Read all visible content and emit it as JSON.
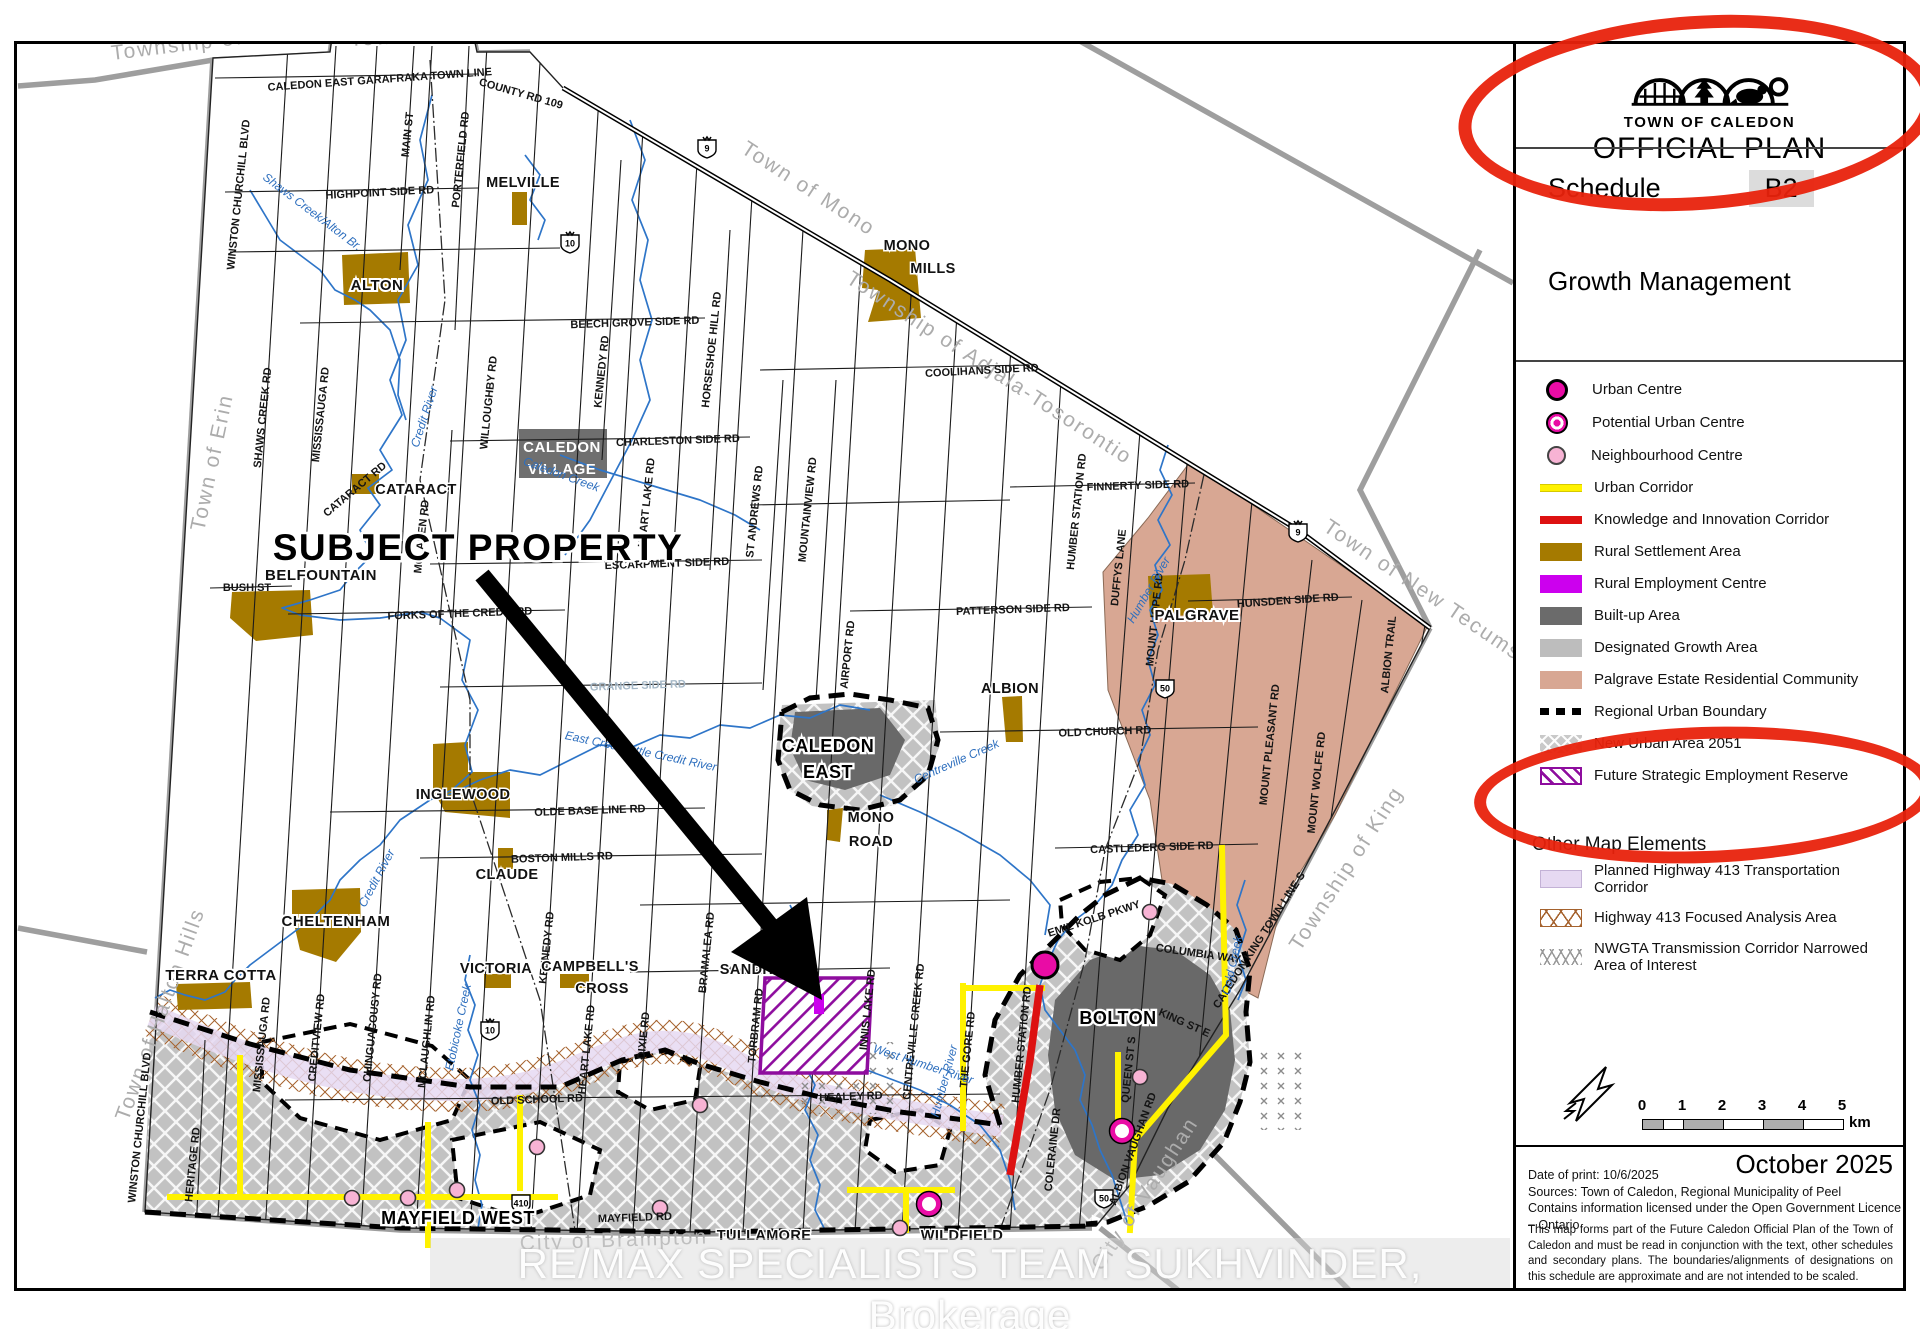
{
  "colors": {
    "accent_red": "#E8220C",
    "water": "#2E75C8",
    "rural_settlement": "#A57A00",
    "rural_employment": "#CC00EE",
    "built_up": "#6B6B6B",
    "designated_growth": "#BDBDBD",
    "palgrave_estate": "#D8A793",
    "urban_centre": "#E90CA5",
    "neighbourhood_centre": "#F7B3D4",
    "urban_corridor": "#FFF200",
    "knowledge_corridor": "#DD1111",
    "future_strategic": "#8E0D9E",
    "hwy413_corridor": "#E6D9F2"
  },
  "legend": {
    "org": "TOWN OF CALEDON",
    "plan": "OFFICIAL PLAN",
    "schedule_label": "Schedule",
    "schedule_value": "B2",
    "title": "Growth Management",
    "items": [
      {
        "label": "Urban Centre",
        "swatch": "urban-centre"
      },
      {
        "label": "Potential Urban Centre",
        "swatch": "potential-urban-centre"
      },
      {
        "label": "Neighbourhood Centre",
        "swatch": "neighbourhood-centre"
      },
      {
        "label": "Urban Corridor",
        "swatch": "urban-corridor"
      },
      {
        "label": "Knowledge and Innovation Corridor",
        "swatch": "knowledge-corridor"
      },
      {
        "label": "Rural Settlement Area",
        "swatch": "rural-settlement"
      },
      {
        "label": "Rural Employment Centre",
        "swatch": "rural-employment"
      },
      {
        "label": "Built-up Area",
        "swatch": "built-up"
      },
      {
        "label": "Designated Growth Area",
        "swatch": "designated-growth"
      },
      {
        "label": "Palgrave Estate Residential Community",
        "swatch": "palgrave-estate"
      },
      {
        "label": "Regional Urban Boundary",
        "swatch": "regional-urban-boundary"
      },
      {
        "label": "New Urban Area 2051",
        "swatch": "new-urban-area"
      },
      {
        "label": "Future Strategic Employment Reserve",
        "swatch": "future-strategic"
      }
    ],
    "other_heading": "Other Map Elements",
    "other_items": [
      {
        "label": "Planned Highway 413 Transportation Corridor",
        "swatch": "hwy413-corridor"
      },
      {
        "label": "Highway 413 Focused Analysis Area",
        "swatch": "hwy413-analysis"
      },
      {
        "label": "NWGTA Transmission Corridor Narrowed Area of Interest",
        "swatch": "nwgta"
      }
    ],
    "scale": {
      "ticks": [
        "0",
        "1",
        "2",
        "3",
        "4",
        "5"
      ],
      "unit": "km"
    },
    "date_big": "October 2025",
    "print_info": [
      "Date of print: 10/6/2025",
      "Sources: Town of Caledon, Regional Municipality of Peel",
      "Contains information licensed under the Open Government Licence – Ontario"
    ],
    "disclaimer": "This map forms part of the Future Caledon Official Plan of the Town of Caledon and must be read in conjunction with the text, other schedules and secondary plans. The boundaries/alignments of designations on this schedule are approximate and are not intended to be scaled."
  },
  "map": {
    "annotation": "SUBJECT PROPERTY",
    "watermark": "RE/MAX SPECIALISTS TEAM SUKHVINDER, Brokerage",
    "route_shields": [
      [
        "9",
        707,
        148
      ],
      [
        "9",
        1298,
        532
      ],
      [
        "10",
        570,
        243
      ],
      [
        "10",
        490,
        1030
      ],
      [
        "410",
        521,
        1203
      ],
      [
        "50",
        1165,
        688
      ],
      [
        "50",
        1104,
        1198
      ]
    ],
    "points": {
      "urban_centres": [
        [
          1045,
          965
        ]
      ],
      "potential_urban_centres": [
        [
          1122,
          1131
        ],
        [
          929,
          1204
        ]
      ],
      "neighbourhood_centres": [
        [
          352,
          1198
        ],
        [
          408,
          1198
        ],
        [
          457,
          1190
        ],
        [
          537,
          1147
        ],
        [
          660,
          1208
        ],
        [
          700,
          1105
        ],
        [
          900,
          1228
        ],
        [
          1150,
          912
        ],
        [
          1140,
          1077
        ]
      ]
    },
    "labels": [
      [
        "Township of East Garafraxa",
        112,
        60,
        -7,
        "m"
      ],
      [
        "Town of Orangeville",
        350,
        46,
        -3,
        "m"
      ],
      [
        "Town of Mono",
        740,
        152,
        33,
        "m"
      ],
      [
        "Township of Adjala-Tosorontio",
        845,
        282,
        33,
        "m"
      ],
      [
        "Town of New Tecumseth",
        1322,
        530,
        34,
        "m"
      ],
      [
        "Township of King",
        1300,
        952,
        -57,
        "m"
      ],
      [
        "City of Vaughan",
        1102,
        1272,
        -57,
        "m"
      ],
      [
        "City of Brampton",
        520,
        1250,
        -2,
        "m"
      ],
      [
        "Town of Halton Hills",
        128,
        1122,
        -70,
        "m"
      ],
      [
        "Town of Erin",
        204,
        532,
        -78,
        "m"
      ],
      [
        "CALEDON EAST GARAFRAKA TOWN LINE",
        380,
        83,
        -4,
        "r"
      ],
      [
        "COUNTY RD 109",
        520,
        97,
        16,
        "r"
      ],
      [
        "HIGHPOINT SIDE RD",
        380,
        196,
        -3,
        "r"
      ],
      [
        "BEECH GROVE SIDE RD",
        635,
        326,
        -2,
        "r"
      ],
      [
        "COOLIHANS SIDE RD",
        982,
        374,
        -3,
        "r"
      ],
      [
        "CHARLESTON SIDE RD",
        678,
        444,
        -2,
        "r"
      ],
      [
        "FINNERTY SIDE RD",
        1138,
        489,
        -2,
        "r"
      ],
      [
        "ESCARPMENT SIDE RD",
        667,
        567,
        -2,
        "r"
      ],
      [
        "BUSH ST",
        247,
        591,
        0,
        "r"
      ],
      [
        "FORKS OF THE CREDIT RD",
        460,
        617,
        -2,
        "r"
      ],
      [
        "HUNSDEN SIDE RD",
        1288,
        604,
        -4,
        "r"
      ],
      [
        "PATTERSON SIDE RD",
        1013,
        613,
        -2,
        "r"
      ],
      [
        "GRANGE SIDE RD",
        638,
        689,
        -2,
        "rf"
      ],
      [
        "OLD CHURCH RD",
        1105,
        735,
        -2,
        "r"
      ],
      [
        "OLDE BASE LINE RD",
        590,
        814,
        -2,
        "r"
      ],
      [
        "CASTLEDERG SIDE RD",
        1152,
        851,
        -2,
        "r"
      ],
      [
        "BOSTON MILLS RD",
        562,
        861,
        -2,
        "r"
      ],
      [
        "KING ST",
        743,
        974,
        -1,
        "r"
      ],
      [
        "OLD SCHOOL RD",
        537,
        1103,
        -2,
        "r"
      ],
      [
        "HEALEY RD",
        851,
        1100,
        -2,
        "r"
      ],
      [
        "MAYFIELD RD",
        635,
        1221,
        -2,
        "r"
      ],
      [
        "EMIL KOLB PKWY",
        1095,
        922,
        -18,
        "r"
      ],
      [
        "COLUMBIA WAY",
        1198,
        957,
        8,
        "r"
      ],
      [
        "KING ST E",
        1183,
        1026,
        24,
        "r"
      ],
      [
        "WINSTON CHURCHILL BLVD",
        242,
        195,
        -84,
        "rv"
      ],
      [
        "WINSTON CHURCHILL BLVD",
        143,
        1128,
        -84,
        "rv"
      ],
      [
        "HERITAGE RD",
        196,
        1165,
        -84,
        "rv"
      ],
      [
        "MISSISSAUGA RD",
        265,
        1045,
        -84,
        "rv"
      ],
      [
        "MISSISSAUGA RD",
        324,
        415,
        -84,
        "rv"
      ],
      [
        "SHAWS CREEK RD",
        266,
        418,
        -84,
        "rv"
      ],
      [
        "CREDITVIEW RD",
        320,
        1038,
        -84,
        "rv"
      ],
      [
        "CHINGUACOUSY RD",
        376,
        1028,
        -84,
        "rv"
      ],
      [
        "MCLAUGHLIN RD",
        430,
        1042,
        -84,
        "rv"
      ],
      [
        "MCLAREN RD",
        425,
        537,
        -84,
        "rv"
      ],
      [
        "WILLOUGHBY RD",
        492,
        403,
        -84,
        "rv"
      ],
      [
        "KENNEDY RD",
        605,
        372,
        -84,
        "rv"
      ],
      [
        "KENNEDY RD",
        550,
        948,
        -84,
        "rv"
      ],
      [
        "HEART LAKE RD",
        650,
        503,
        -84,
        "rv"
      ],
      [
        "HEART LAKE RD",
        590,
        1050,
        -84,
        "rv"
      ],
      [
        "DIXIE RD",
        647,
        1036,
        -84,
        "rv"
      ],
      [
        "MAIN ST",
        411,
        135,
        -84,
        "rv"
      ],
      [
        "PORTERFIELD RD",
        464,
        160,
        -84,
        "rv"
      ],
      [
        "HORSESHOE HILL RD",
        715,
        350,
        -84,
        "rv"
      ],
      [
        "ST ANDREWS RD",
        758,
        512,
        -84,
        "rv"
      ],
      [
        "MOUNTAINVIEW RD",
        811,
        510,
        -84,
        "rv"
      ],
      [
        "AIRPORT RD",
        851,
        655,
        -84,
        "rv"
      ],
      [
        "BRAMALEA RD",
        710,
        953,
        -84,
        "rv"
      ],
      [
        "TORBRAM RD",
        759,
        1026,
        -84,
        "rv"
      ],
      [
        "INNIS LAKE RD",
        871,
        1010,
        -84,
        "rv"
      ],
      [
        "CENTREVILLE CREEK RD",
        917,
        1032,
        -84,
        "rv"
      ],
      [
        "THE GORE RD",
        971,
        1050,
        -84,
        "rv"
      ],
      [
        "HUMBER STATION RD",
        1025,
        1045,
        -84,
        "rv"
      ],
      [
        "HUMBER STATION RD",
        1080,
        512,
        -84,
        "rv"
      ],
      [
        "DUFFYS LANE",
        1122,
        568,
        -84,
        "rv"
      ],
      [
        "MOUNT HOPE RD",
        1158,
        620,
        -84,
        "rv"
      ],
      [
        "MOUNT PLEASANT RD",
        1273,
        745,
        -84,
        "rv"
      ],
      [
        "MOUNT WOLFE RD",
        1320,
        783,
        -84,
        "rv"
      ],
      [
        "ALBION TRAIL",
        1392,
        655,
        -84,
        "rv"
      ],
      [
        "COLERAINE DR",
        1056,
        1150,
        -84,
        "rv"
      ],
      [
        "ALBION VAUGHAN RD",
        1136,
        1150,
        -70,
        "rv"
      ],
      [
        "QUEEN ST S",
        1132,
        1070,
        -84,
        "rv"
      ],
      [
        "CALEDON KING TOWN LINE S",
        1262,
        942,
        -57,
        "rv"
      ],
      [
        "CATARACT RD",
        357,
        492,
        -40,
        "rv"
      ],
      [
        "ALTON",
        377,
        290,
        0,
        "sh"
      ],
      [
        "MELVILLE",
        523,
        187,
        0,
        "s"
      ],
      [
        "MONO",
        907,
        250,
        0,
        "s"
      ],
      [
        "MILLS",
        933,
        273,
        0,
        "s"
      ],
      [
        "CATARACT",
        416,
        494,
        0,
        "s"
      ],
      [
        "BELFOUNTAIN",
        321,
        580,
        0,
        "sh"
      ],
      [
        "CALEDON",
        562,
        452,
        0,
        "si"
      ],
      [
        "VILLAGE",
        562,
        474,
        0,
        "si"
      ],
      [
        "INGLEWOOD",
        463,
        799,
        0,
        "s"
      ],
      [
        "CLAUDE",
        507,
        879,
        0,
        "s"
      ],
      [
        "CHELTENHAM",
        336,
        926,
        0,
        "sh"
      ],
      [
        "TERRA COTTA",
        221,
        980,
        0,
        "sh"
      ],
      [
        "VICTORIA",
        496,
        973,
        0,
        "s"
      ],
      [
        "CAMPBELL'S",
        590,
        971,
        0,
        "s"
      ],
      [
        "CROSS",
        602,
        993,
        0,
        "s"
      ],
      [
        "ALBION",
        1010,
        693,
        0,
        "s"
      ],
      [
        "MONO",
        871,
        822,
        0,
        "s"
      ],
      [
        "ROAD",
        871,
        846,
        0,
        "s"
      ],
      [
        "PALGRAVE",
        1197,
        620,
        0,
        "sh"
      ],
      [
        "CALEDON",
        828,
        752,
        0,
        "sb"
      ],
      [
        "EAST",
        828,
        778,
        0,
        "sb"
      ],
      [
        "BOLTON",
        1118,
        1024,
        0,
        "sb"
      ],
      [
        "MAYFIELD WEST",
        458,
        1224,
        0,
        "sb"
      ],
      [
        "TULLAMORE",
        764,
        1240,
        0,
        "s"
      ],
      [
        "WILDFIELD",
        962,
        1240,
        0,
        "s"
      ],
      [
        "SANDHILL",
        758,
        974,
        0,
        "s"
      ],
      [
        "Shaws Creek/Alton Br.",
        310,
        215,
        37,
        "w"
      ],
      [
        "Credit River",
        428,
        418,
        -72,
        "w"
      ],
      [
        "Caledon Creek",
        560,
        478,
        20,
        "w"
      ],
      [
        "East Credit/Little Credit River",
        640,
        755,
        12,
        "w"
      ],
      [
        "Centreville Creek",
        958,
        765,
        -24,
        "w"
      ],
      [
        "West Humber River",
        922,
        1068,
        18,
        "w"
      ],
      [
        "Humber River",
        1152,
        592,
        -60,
        "w"
      ],
      [
        "Humber River",
        948,
        1082,
        -75,
        "w"
      ],
      [
        "Cold Creek",
        1236,
        966,
        -78,
        "w"
      ],
      [
        "Etobicoke Creek",
        462,
        1028,
        -78,
        "w"
      ],
      [
        "Credit River",
        380,
        880,
        -62,
        "w"
      ],
      [
        "SUBJECT PROPERTY",
        478,
        560,
        0,
        "a"
      ]
    ]
  }
}
